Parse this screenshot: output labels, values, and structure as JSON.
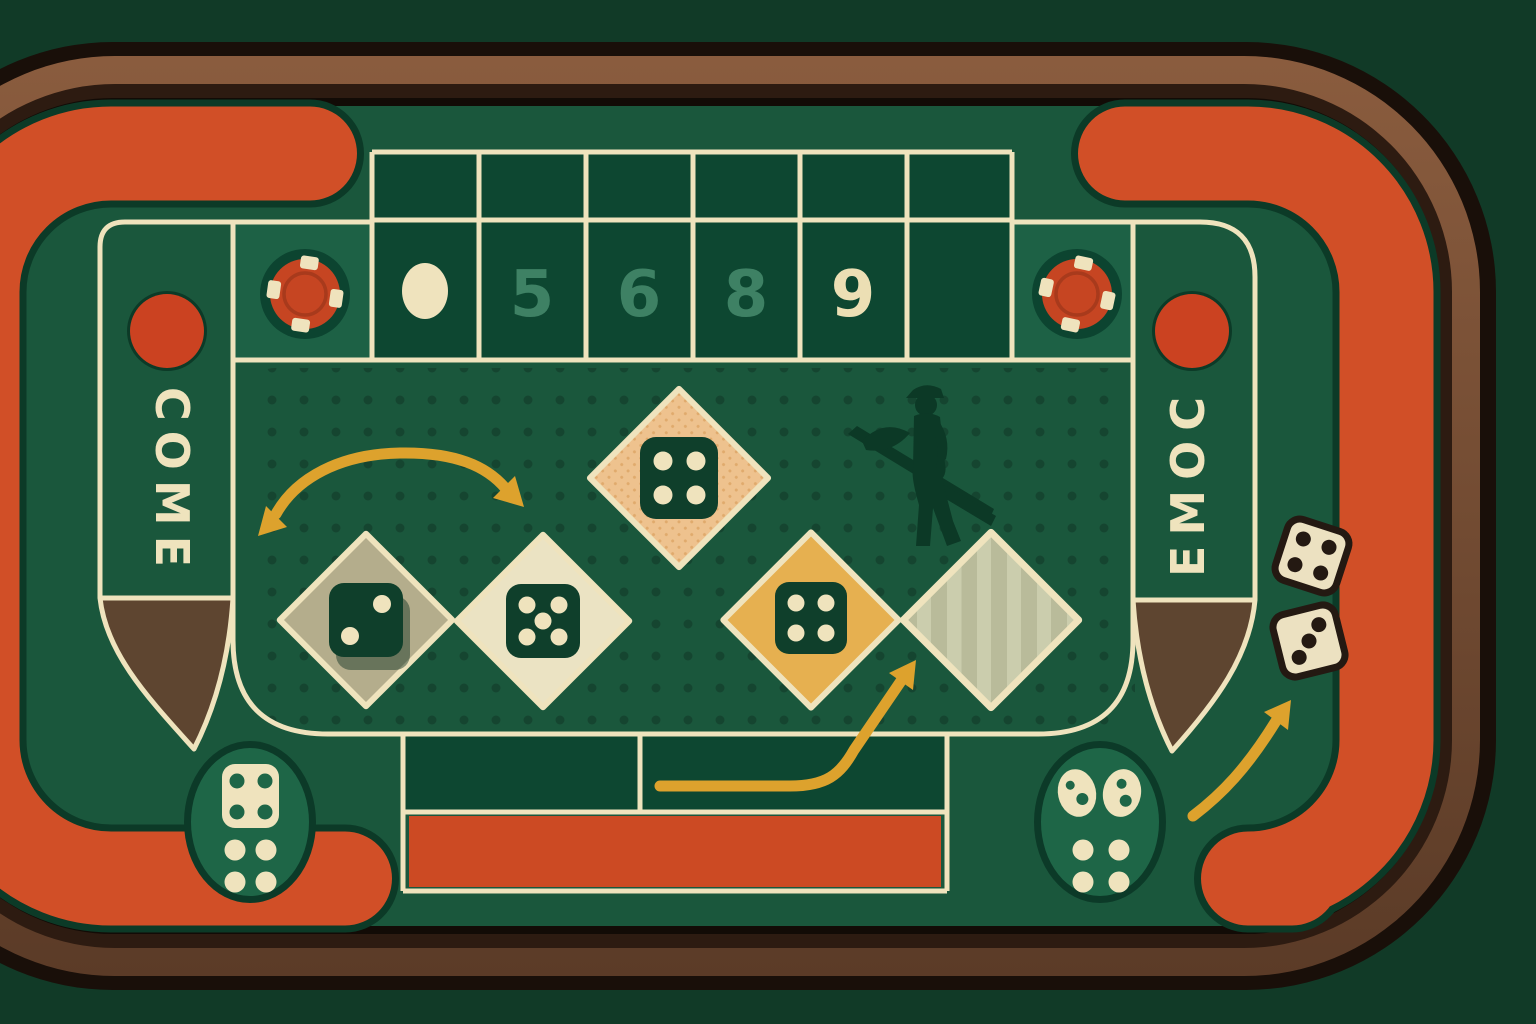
{
  "title": "craps-table-illustration",
  "palette": {
    "bg": "#113a27",
    "felt": "#1a573c",
    "felt_cell_dark": "#0d4731",
    "felt_cell_light": "#1d6145",
    "dot": "#123f2c",
    "cream": "#efe3bd",
    "orange": "#d14f27",
    "orange_rect": "#cc4a23",
    "orange_rim": "#0c3a27",
    "rail_outline": "#190f09",
    "rail_brown_light": "#8a5c3e",
    "rail_brown_dark": "#2d1b11",
    "rail_black": "#120b06",
    "wedge_brown": "#5e4530",
    "chip_red": "#c64522",
    "chip_red_dark": "#a83a1c",
    "circle_red": "#cb4221",
    "teal_number": "#3e8164",
    "cream_number": "#ecdfb4",
    "die_green": "#0f3f2b",
    "diamond_khaki": "#b4ad8c",
    "diamond_cream": "#ebe3c3",
    "diamond_peach": "#eec28e",
    "diamond_gold": "#e6b050",
    "diamond_sage": "#b9bb9a",
    "sage_stripe": "#cbcdad",
    "silhouette": "#0c3926",
    "oval_green": "#1e6647",
    "arrow_gold": "#dda22d",
    "dice_cream": "#ece1c1",
    "dice_outline": "#241912"
  },
  "table": {
    "come_label": "COME",
    "point_numbers": [
      "5",
      "6",
      "8",
      "9"
    ],
    "point_number_colors": [
      "#3e8164",
      "#3e8164",
      "#3e8164",
      "#ecdfb4"
    ],
    "puck": "blank-cream-puck",
    "top_grid": {
      "thin_row_cells": 6,
      "number_row_cells": 6,
      "empty_cells": 2
    }
  },
  "chips": [
    {
      "position": "top-left",
      "color": "#c64522",
      "edge_spots": 4
    },
    {
      "position": "top-right",
      "color": "#c64522",
      "edge_spots": 4
    }
  ],
  "come_circles": [
    {
      "position": "left",
      "color": "#cb4221"
    },
    {
      "position": "right",
      "color": "#cb4221"
    }
  ],
  "diamonds": [
    {
      "order": 1,
      "fill": "#b4ad8c",
      "die_pips": 2
    },
    {
      "order": 2,
      "fill": "#ebe3c3",
      "die_pips": 5
    },
    {
      "order": 3,
      "fill": "#eec28e",
      "die_pips": 4
    },
    {
      "order": 4,
      "fill": "#e6b050",
      "die_pips": 4
    },
    {
      "order": 5,
      "fill": "#b9bb9a",
      "die_pips": 0,
      "texture": "diagonal-stripes"
    }
  ],
  "loose_dice": [
    {
      "position": "right-rail-upper",
      "pips": 4
    },
    {
      "position": "right-rail-lower",
      "pips": 3
    }
  ],
  "corner_icons": [
    {
      "position": "bottom-left",
      "type": "die-with-four-pips-and-four-dots"
    },
    {
      "position": "bottom-right",
      "type": "two-tilted-dice-and-four-dots"
    }
  ],
  "arrows": [
    {
      "type": "double-headed-arc",
      "area": "upper-left-field"
    },
    {
      "type": "curved-up-right",
      "area": "bottom-center"
    },
    {
      "type": "curved-up-right",
      "area": "bottom-right"
    }
  ],
  "silhouette": {
    "type": "stickman-dealer-holding-stick"
  },
  "wedges": [
    {
      "position": "left",
      "color": "#5e4530"
    },
    {
      "position": "right",
      "color": "#5e4530"
    }
  ]
}
